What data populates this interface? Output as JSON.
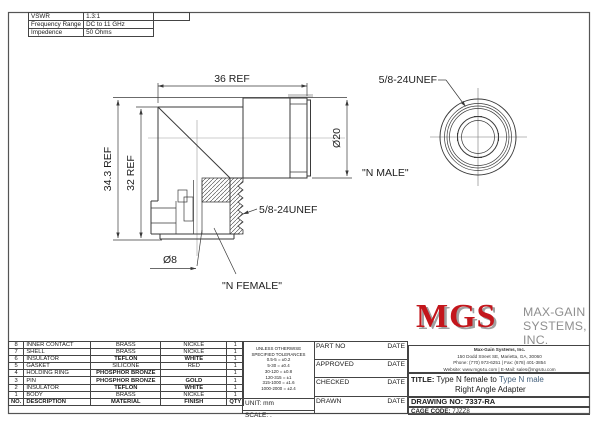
{
  "colors": {
    "logo_red": "#c3161c",
    "line": "#3a3a3a",
    "centerline": "#9b9b9b",
    "muted": "#8f8f8f",
    "link_blue": "#46627e"
  },
  "spec": {
    "rows": [
      {
        "label": "VSWR",
        "value": "1.3:1"
      },
      {
        "label": "Frequency Range",
        "value": "DC to 11 GHz"
      },
      {
        "label": "Impedence",
        "value": "50 Ohms"
      }
    ]
  },
  "drawing": {
    "dim_width": "36 REF",
    "dim_height_outer": "34.3 REF",
    "dim_height_inner": "32 REF",
    "dia_male": "Ø20",
    "dia_female": "Ø8",
    "thread_left": "5/8-24UNEF",
    "thread_right": "5/8-24UNEF",
    "label_female": "\"N FEMALE\"",
    "label_male": "\"N MALE\""
  },
  "parts": {
    "headers": [
      "NO.",
      "DESCRIPTION",
      "MATERIAL",
      "FINISH",
      "QTY"
    ],
    "rows": [
      [
        "8",
        "INNER CONTACT",
        "BRASS",
        "NICKLE",
        "1"
      ],
      [
        "7",
        "SHELL",
        "BRASS",
        "NICKLE",
        "1"
      ],
      [
        "6",
        "INSULATOR",
        "TEFLON",
        "WHITE",
        "1"
      ],
      [
        "5",
        "GASKET",
        "SILICONE",
        "RED",
        "1"
      ],
      [
        "4",
        "HOLDING RING",
        "PHOSPHOR  BRONZE",
        "",
        "1"
      ],
      [
        "3",
        "PIN",
        "PHOSPHOR  BRONZE",
        "GOLD",
        "1"
      ],
      [
        "2",
        "INSULATOR",
        "TEFLON",
        "WHITE",
        "1"
      ],
      [
        "1",
        "BODY",
        "BRASS",
        "NICKLE",
        "1"
      ]
    ]
  },
  "tolerances": {
    "heading1": "UNLESS OTHERWISE",
    "heading2": "SPECIFIED TOLERANCES",
    "lines": [
      "0.5-5 = ±0.2",
      "5-30 = ±0.4",
      "30-120 = ±0.8",
      "120-315 = ±1",
      "315-1000 = ±1.6",
      "1000-2000 = ±2.4"
    ],
    "unit_label": "UNIT:",
    "unit_value": "mm",
    "scale_label": "SCALE:",
    "scale_value": "."
  },
  "approvals": {
    "rows": [
      {
        "label": "PART NO",
        "date": "DATE"
      },
      {
        "label": "APPROVED",
        "date": "DATE"
      },
      {
        "label": "CHECKED",
        "date": "DATE"
      },
      {
        "label": "DRAWN",
        "date": "DATE"
      }
    ]
  },
  "company": {
    "logo": "MGS",
    "name_line1": "MAX-GAIN",
    "name_line2": "SYSTEMS, INC.",
    "address_line1": "Max-Gain Systems, Inc.",
    "address_line2": "150 Dodd Street SE, Marietta, GA, 30060",
    "address_line3": "Phone: (770) 973-6251 | Fax: (678) 401-3854",
    "address_line4": "Website: www.mgs4u.com | E-Mail: sales@mgs4u.com"
  },
  "title_block": {
    "title_label": "TITLE:",
    "title_line1_a": "Type N female to",
    "title_line1_b": "Type N male",
    "title_line2": "Right Angle Adapter",
    "drawing_no_label": "DRAWING  NO:",
    "drawing_no": "7337-RA",
    "cage_label": "CAGE CODE:",
    "cage_value": "7JZZ8"
  }
}
